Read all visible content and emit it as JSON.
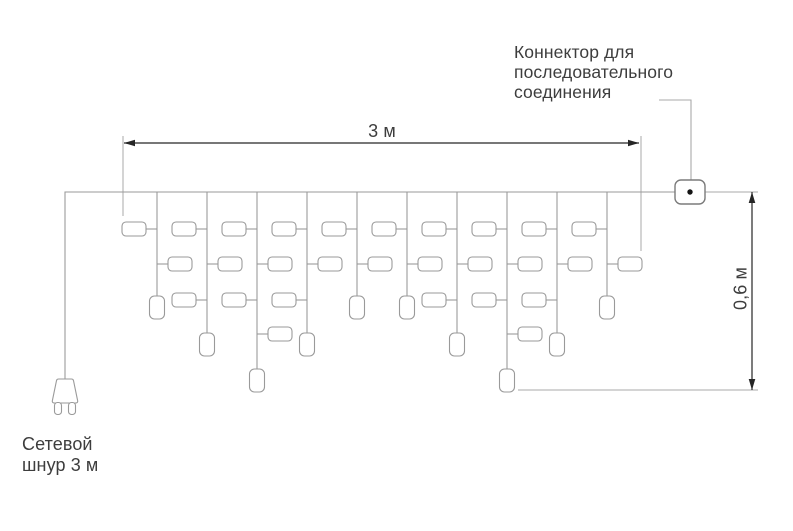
{
  "labels": {
    "connector": "Коннектор для\nпоследовательного\nсоединения",
    "power_cord": "Сетевой\nшнур 3 м",
    "width_dim": "3 м",
    "height_dim": "0,6 м"
  },
  "colors": {
    "background": "#ffffff",
    "wire": "#9a9a9a",
    "construction": "#a9a9a9",
    "dimension": "#262626",
    "connector_stroke": "#7b7b7b",
    "connector_dot": "#141414",
    "text": "#3d3d3d",
    "bulb_fill": "#ffffff"
  },
  "diagram": {
    "canvas": {
      "width": 793,
      "height": 531
    },
    "main_wire": {
      "y": 192,
      "x_start": 65,
      "x_end": 676
    },
    "power_cord": {
      "x": 65,
      "plug_top_y": 379,
      "plug_body_h": 24,
      "prong_h": 12
    },
    "drops": [
      {
        "x": 157,
        "size": "short"
      },
      {
        "x": 207,
        "size": "medium"
      },
      {
        "x": 257,
        "size": "long"
      },
      {
        "x": 307,
        "size": "medium"
      },
      {
        "x": 357,
        "size": "short"
      },
      {
        "x": 407,
        "size": "short"
      },
      {
        "x": 457,
        "size": "medium"
      },
      {
        "x": 507,
        "size": "long"
      },
      {
        "x": 557,
        "size": "medium"
      },
      {
        "x": 607,
        "size": "short"
      }
    ],
    "drop_end_y": {
      "short": 296,
      "medium": 333,
      "long": 369
    },
    "rows_per_size": {
      "short": 2,
      "medium": 3,
      "long": 4
    },
    "bulb_rows_y": [
      229,
      264,
      300,
      334
    ],
    "bulb": {
      "w": 24,
      "h": 14,
      "stub": 11,
      "rx": 4
    },
    "pendant": {
      "w": 15,
      "h": 23,
      "rx": 5
    },
    "connector_box": {
      "x": 675,
      "y": 180,
      "w": 30,
      "h": 24,
      "rx": 6,
      "dot_r": 2.7
    },
    "tail_wire": {
      "x_end": 758
    },
    "leader": {
      "points": [
        [
          659,
          100
        ],
        [
          691,
          100
        ],
        [
          691,
          180
        ]
      ]
    },
    "dim_width": {
      "y": 143,
      "x1": 124,
      "x2": 639,
      "ext_left": {
        "x": 123,
        "y1": 136,
        "y2": 216
      },
      "ext_right": {
        "x": 641,
        "y1": 136,
        "y2": 251
      }
    },
    "dim_height": {
      "x": 752,
      "y1": 192,
      "y2": 390,
      "ref_line": {
        "y": 390,
        "x1": 518,
        "x2": 758
      }
    },
    "arrow": {
      "len": 11,
      "half_w": 3.3
    }
  }
}
